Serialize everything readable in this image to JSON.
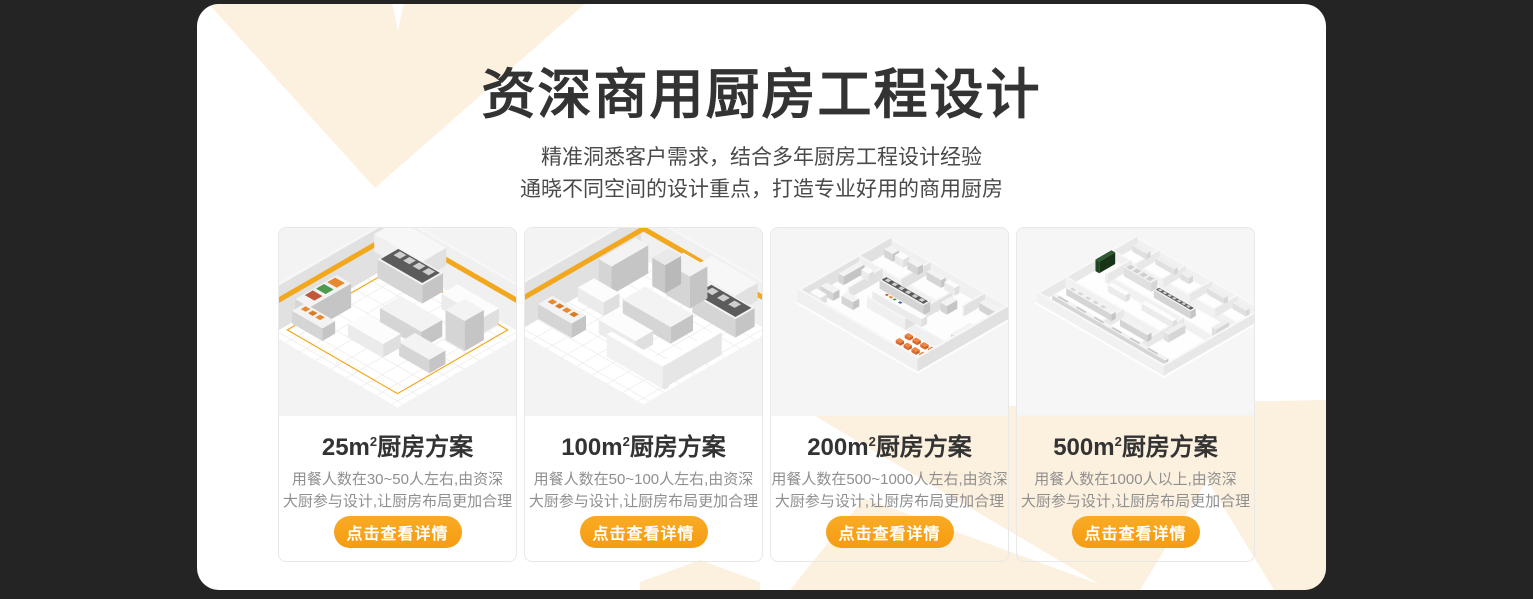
{
  "theme": {
    "page_background": "#242424",
    "panel_background": "#ffffff",
    "accent_orange": "#f7a118",
    "decoration_cream": "#fcf0df",
    "title_color": "#333333",
    "description_color": "#8f8f8f"
  },
  "header": {
    "title": "资深商用厨房工程设计",
    "subtitle": "精准洞悉客户需求，结合多年厨房工程设计经验\n通晓不同空间的设计重点，打造专业好用的商用厨房"
  },
  "cards": [
    {
      "size": "25m",
      "sup": "2",
      "suffix": "厨房方案",
      "description": "用餐人数在30~50人左右,由资深\n大厨参与设计,让厨房布局更加合理",
      "cta": "点击查看详情"
    },
    {
      "size": "100m",
      "sup": "2",
      "suffix": "厨房方案",
      "description": "用餐人数在50~100人左右,由资深\n大厨参与设计,让厨房布局更加合理",
      "cta": "点击查看详情"
    },
    {
      "size": "200m",
      "sup": "2",
      "suffix": "厨房方案",
      "description": "用餐人数在500~1000人左右,由资深\n大厨参与设计,让厨房布局更加合理",
      "cta": "点击查看详情"
    },
    {
      "size": "500m",
      "sup": "2",
      "suffix": "厨房方案",
      "description": "用餐人数在1000人以上,由资深\n大厨参与设计,让厨房布局更加合理",
      "cta": "点击查看详情"
    }
  ]
}
